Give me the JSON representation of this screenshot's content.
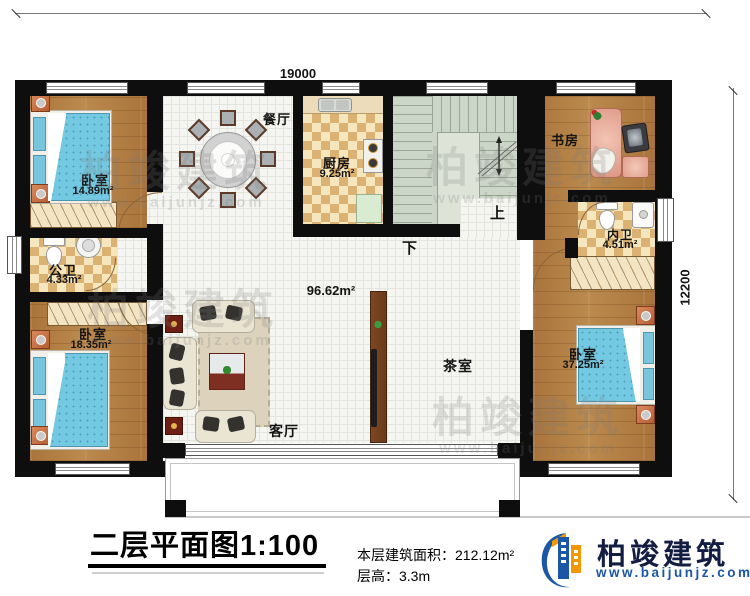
{
  "dims": {
    "top": "19000",
    "right": "12200"
  },
  "rooms": {
    "bedroom_tl": {
      "name": "卧室",
      "area": "14.89m²"
    },
    "public_bath": {
      "name": "公卫",
      "area": "4.33m²"
    },
    "bedroom_bl": {
      "name": "卧室",
      "area": "18.35m²"
    },
    "dining": {
      "name": "餐厅"
    },
    "kitchen": {
      "name": "厨房",
      "area": "9.25m²"
    },
    "study": {
      "name": "书房"
    },
    "ensuite_bath": {
      "name": "内卫",
      "area": "4.51m²"
    },
    "bedroom_br": {
      "name": "卧室",
      "area": "37.25m²"
    },
    "living": {
      "name": "客厅"
    },
    "tea_room": {
      "name": "茶室"
    },
    "open_area": "96.62m²"
  },
  "stairs": {
    "up": "上",
    "down": "下"
  },
  "titleblock": {
    "title": "二层平面图1:100",
    "area_label": "本层建筑面积：",
    "area_value": "212.12m²",
    "height_label": "层高：",
    "height_value": "3.3m"
  },
  "branding": {
    "name": "柏竣建筑",
    "website": "www.baijunjz.com",
    "colors": {
      "blue": "#1b57a5",
      "orange": "#f39800",
      "navy": "#131d42"
    }
  },
  "watermark": {
    "text": "柏竣建筑",
    "url": "www.baijunjz.com"
  }
}
